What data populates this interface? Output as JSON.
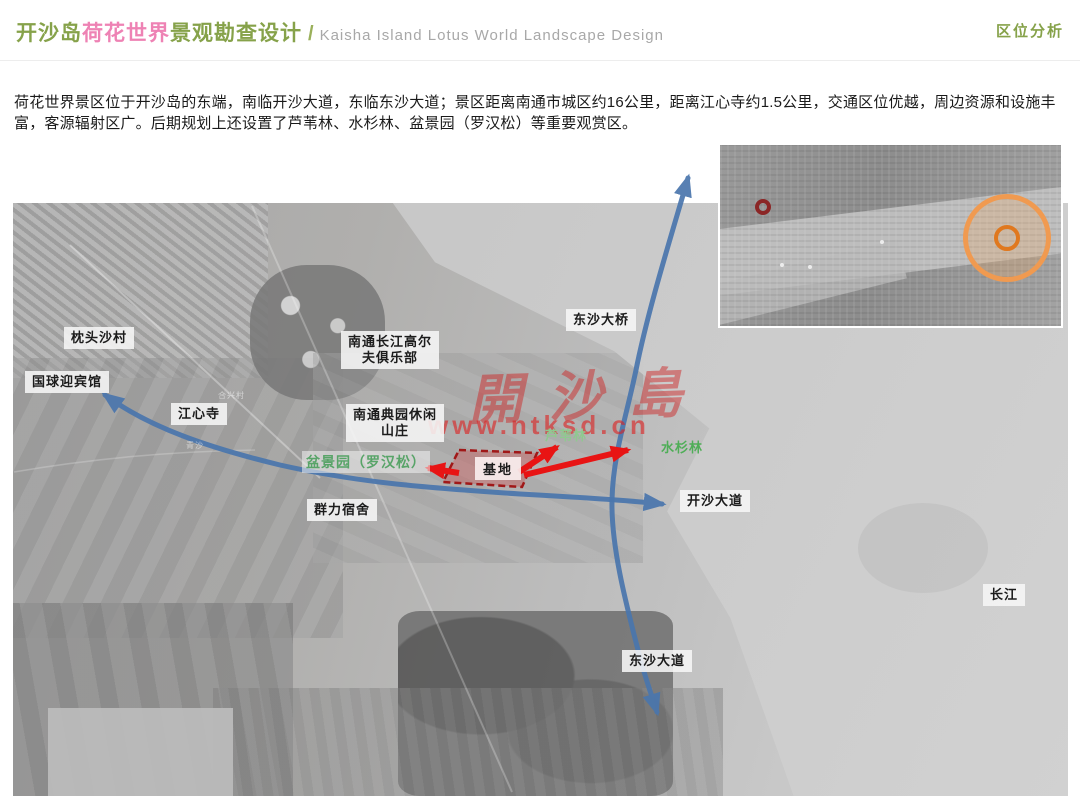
{
  "header": {
    "title_parts": [
      {
        "text": "开沙岛"
      },
      {
        "text": "荷花世界"
      },
      {
        "text": "景观勘查设计"
      }
    ],
    "separator": "/",
    "title_en": "Kaisha Island Lotus World Landscape Design",
    "section_label": "区位分析"
  },
  "intro": {
    "text": "荷花世界景区位于开沙岛的东端，南临开沙大道，东临东沙大道；景区距离南通市城区约16公里，距离江心寺约1.5公里，交通区位优越，周边资源和设施丰富，客源辐射区广。后期规划上还设置了芦苇林、水杉林、盆景园（罗汉松）等重要观赏区。"
  },
  "map": {
    "place_labels": [
      {
        "text": "枕头沙村"
      },
      {
        "text": "国球迎宾馆"
      },
      {
        "text": "江心寺"
      },
      {
        "text": "南通长江高尔\n夫俱乐部"
      },
      {
        "text": "南通典园休闲\n山庄"
      },
      {
        "text": "东沙大桥"
      },
      {
        "text": "群力宿舍"
      },
      {
        "text": "开沙大道"
      },
      {
        "text": "东沙大道"
      },
      {
        "text": "长江"
      }
    ],
    "feature_labels": [
      {
        "text": "盆景园（罗汉松）"
      },
      {
        "text": "芦苇林"
      },
      {
        "text": "水杉林"
      }
    ],
    "site_label": "基地",
    "tiny_labels": [
      {
        "text": "合兴村"
      },
      {
        "text": "青沙"
      }
    ],
    "watermark": {
      "characters": "開沙島",
      "url": "www.ntksd.cn"
    }
  },
  "colors": {
    "title_green": "#86a24a",
    "title_pink": "#ee82b4",
    "title_en_gray": "#a8a8a8",
    "route_blue": "#4a76ad",
    "arrow_red": "#e81414",
    "site_fill": "rgba(205,90,90,0.42)",
    "site_border": "#a01818",
    "feature_green": "#58a468",
    "reed_green": "#8fc98f",
    "metasequoia_green": "#4fae57",
    "watermark_red": "rgba(220,40,40,0.55)",
    "inset_site_ring": "#8b2626",
    "inset_city_ring": "#f09a50"
  }
}
